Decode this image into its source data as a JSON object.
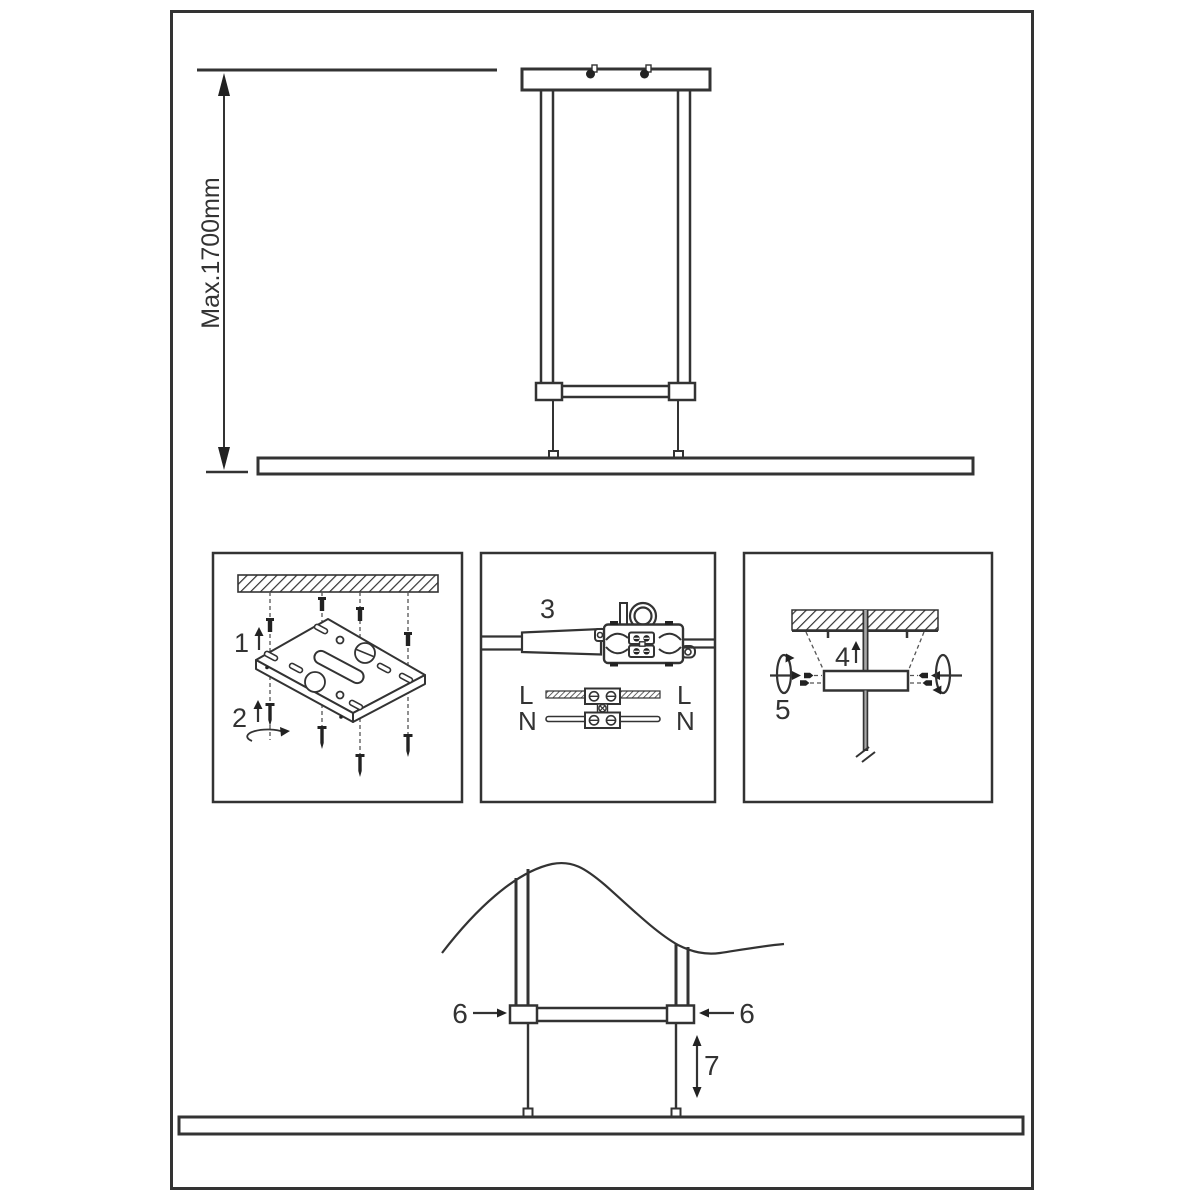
{
  "colors": {
    "line": "#333333",
    "gray_rod": "#a8a8a8",
    "background": "#ffffff"
  },
  "overview": {
    "dimension_label": "Max.1700mm"
  },
  "panel_mounting_plate": {
    "step_anchor": "1",
    "step_screw": "2"
  },
  "panel_wiring": {
    "step_connect": "3",
    "live_left": "L",
    "live_right": "L",
    "neutral_left": "N",
    "neutral_right": "N"
  },
  "panel_canopy": {
    "step_push": "4",
    "step_tighten": "5"
  },
  "adjustment": {
    "step_clamp_left": "6",
    "step_clamp_right": "6",
    "step_height": "7"
  }
}
